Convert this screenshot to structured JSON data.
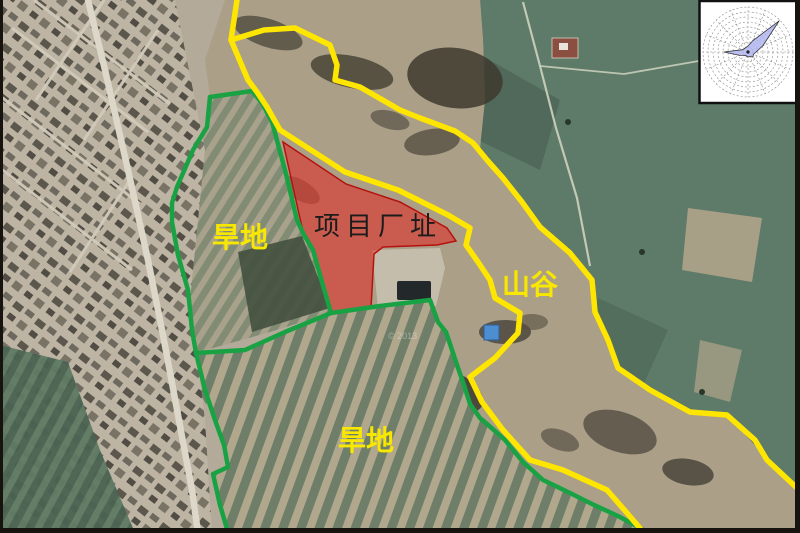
{
  "map": {
    "title": "project-site-satellite-map",
    "labels": {
      "project_site": "项目厂址",
      "dry_land_upper": "旱地",
      "dry_land_lower": "旱地",
      "valley": "山谷"
    },
    "watermark": "© 2013",
    "colors": {
      "project_site_fill": "#e2251f",
      "project_site_stroke": "#b5120e",
      "boundary_green": "#18a244",
      "boundary_yellow": "#ffe600",
      "label_yellow": "#f8e800",
      "label_black": "#1c1c1c",
      "wind_rose_fill": "#b2b6f0"
    },
    "wind_rose": {
      "position": "top-right",
      "main_lobe_direction": "NE",
      "secondary_lobe_direction": "W",
      "fill": "#b2b6f0"
    }
  }
}
